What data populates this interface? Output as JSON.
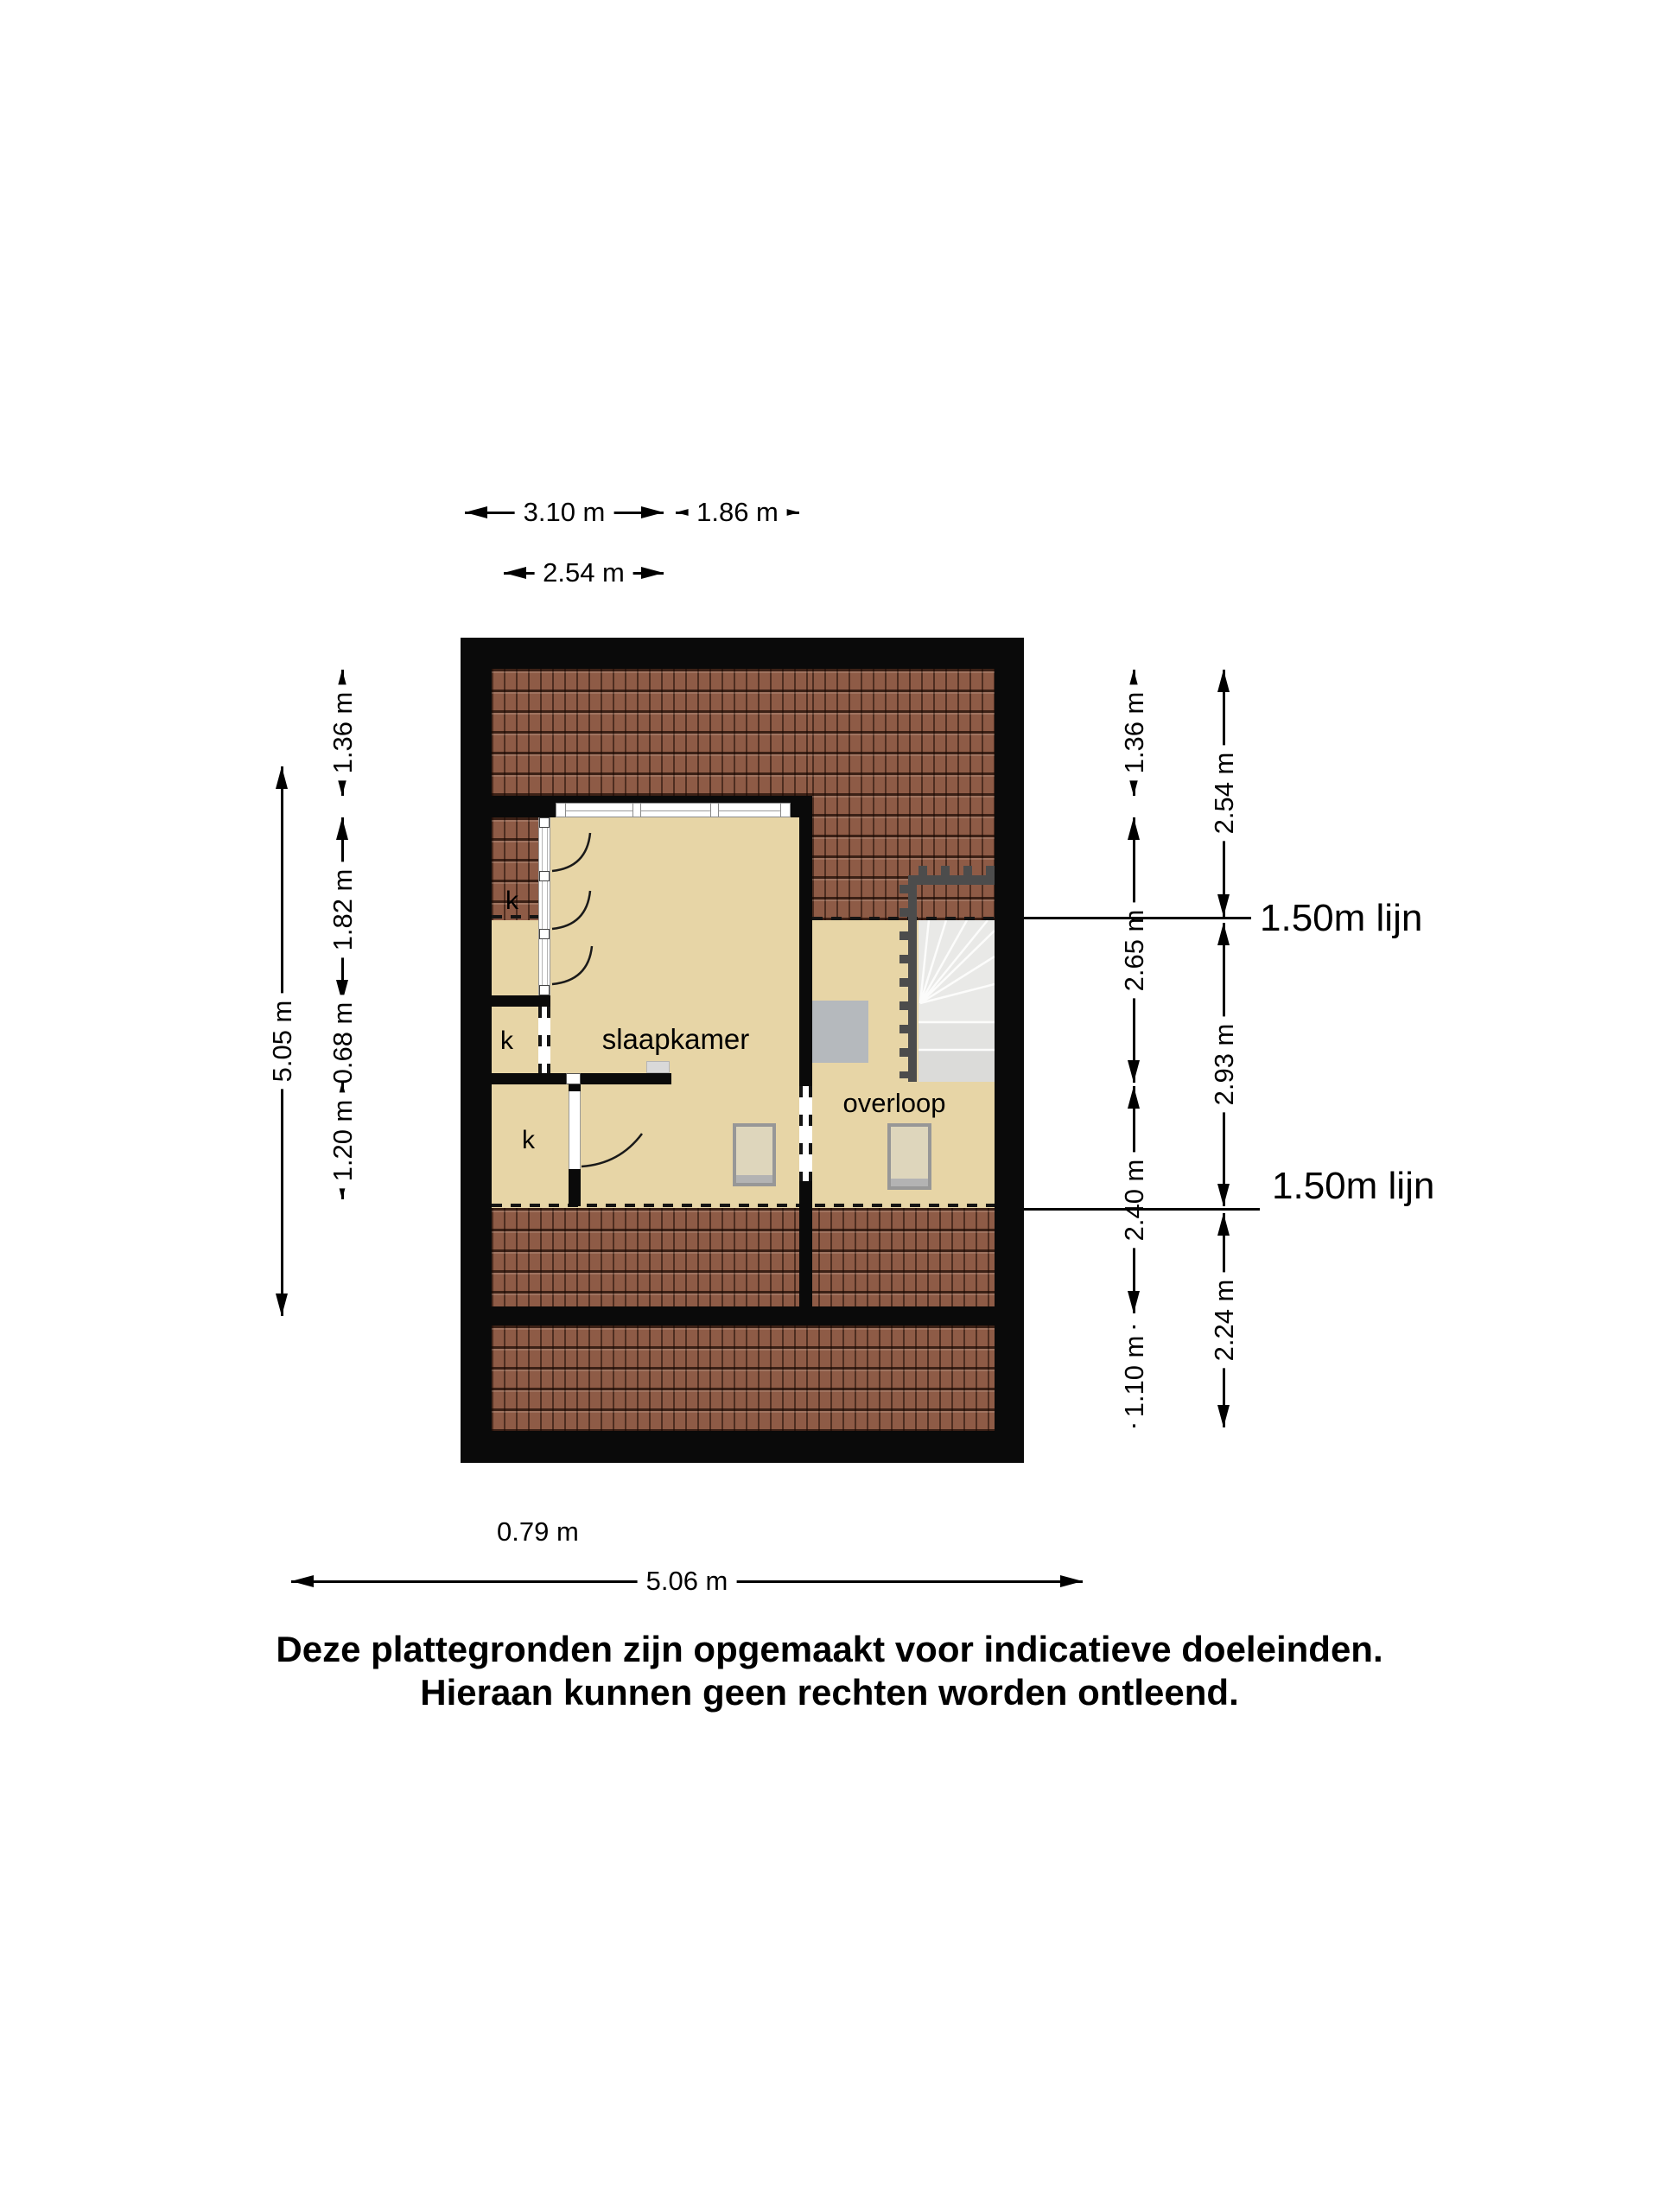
{
  "dims": {
    "top": [
      {
        "label": "3.10 m"
      },
      {
        "label": "1.86 m"
      },
      {
        "label": "2.54 m"
      }
    ],
    "left_outer": {
      "label": "5.05 m"
    },
    "left_inner": [
      "1.36 m",
      "1.82 m",
      "0.68 m",
      "1.20 m"
    ],
    "right_inner": [
      "1.36 m",
      "2.65 m",
      "2.40 m",
      "1.10 m"
    ],
    "right_outer": [
      "2.54 m",
      "2.93 m",
      "2.24 m"
    ],
    "bottom": [
      {
        "label": "0.79 m"
      },
      {
        "label": "5.06 m"
      }
    ],
    "level_lines": [
      {
        "label": "1.50m lijn"
      },
      {
        "label": "1.50m lijn"
      }
    ]
  },
  "rooms": {
    "bedroom": "slaapkamer",
    "landing": "overloop",
    "closets": [
      "k",
      "k",
      "k"
    ]
  },
  "disclaimer": [
    "Deze plattegronden zijn opgemaakt voor indicatieve doeleinden.",
    "Hieraan kunnen geen rechten worden ontleend."
  ],
  "colors": {
    "ink": "#000000",
    "wall": "#0a0a0a",
    "tile": "#8e5b46",
    "floor": "#e7d5a6",
    "stair_light": "#e9e9e7",
    "railing": "#4c4c4c",
    "duct": "#b5b9bd",
    "skylight": "#ded6bc",
    "skylight_frame": "#979797"
  }
}
